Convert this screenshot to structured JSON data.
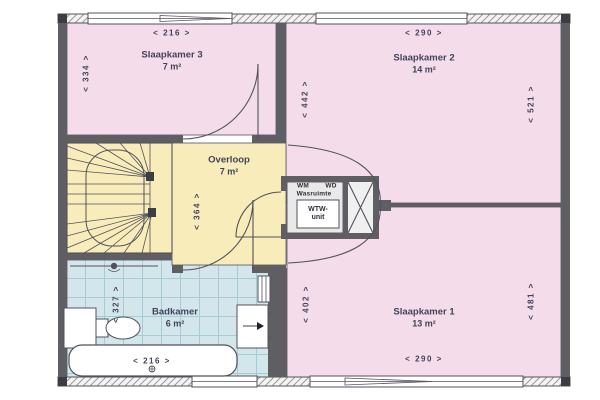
{
  "colors": {
    "room_pink": "#f5dcea",
    "room_yellow": "#f8ecba",
    "tile_blue": "#d2e6ec",
    "tile_line": "#a6cbd4",
    "gray_room": "#e9e9e9",
    "wall": "#5f5f63",
    "line": "#52525c",
    "text": "#42425a"
  },
  "rooms": {
    "slaapkamer3": {
      "name": "Slaapkamer 3",
      "area": "7 m²"
    },
    "slaapkamer2": {
      "name": "Slaapkamer 2",
      "area": "14 m²"
    },
    "slaapkamer1": {
      "name": "Slaapkamer 1",
      "area": "13 m²"
    },
    "overloop": {
      "name": "Overloop",
      "area": "7 m²"
    },
    "badkamer": {
      "name": "Badkamer",
      "area": "6 m²"
    },
    "wasruimte": {
      "name": "Wasruimte",
      "wm": "WM",
      "wd": "WD",
      "wtw_line1": "WTW-",
      "wtw_line2": "unit"
    }
  },
  "dimensions": {
    "sk3_width": "<  216  >",
    "sk3_depth": "<  334  >",
    "sk2_width": "<  290  >",
    "sk2_depth_left": "<  442  >",
    "sk2_depth_right": "<  521  >",
    "overloop_depth": "<  364  >",
    "badkamer_depth": "<  327  >",
    "badkamer_width": "<  216  >",
    "sk1_depth_left": "<  402  >",
    "sk1_depth_right": "<  481  >",
    "sk1_width": "<  290  >"
  }
}
